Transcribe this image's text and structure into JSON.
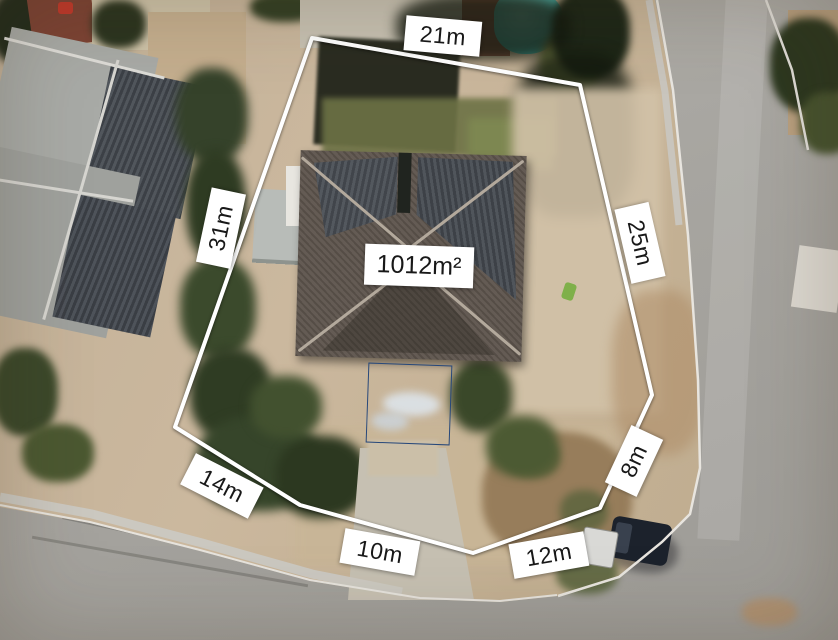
{
  "overlay": {
    "area": {
      "label": "1012m²"
    },
    "dimensions": [
      {
        "side": "top",
        "label": "21m"
      },
      {
        "side": "left",
        "label": "31m"
      },
      {
        "side": "right",
        "label": "25m"
      },
      {
        "side": "right-lower",
        "label": "8m"
      },
      {
        "side": "bottom-right",
        "label": "12m"
      },
      {
        "side": "bottom",
        "label": "10m"
      },
      {
        "side": "bottom-left",
        "label": "14m"
      }
    ],
    "colors": {
      "boundary": "#ffffff",
      "label_background": "#ffffff",
      "label_text": "#181818"
    }
  },
  "scene": {
    "type": "aerial-photo",
    "colors": {
      "pool": "#45b0a8",
      "road": "#a7a5a0",
      "roof_main": "#5f564e",
      "roof_neighbour": "#a8aaa6",
      "dirt": "#c8b79e",
      "trees": "#35422a"
    }
  }
}
